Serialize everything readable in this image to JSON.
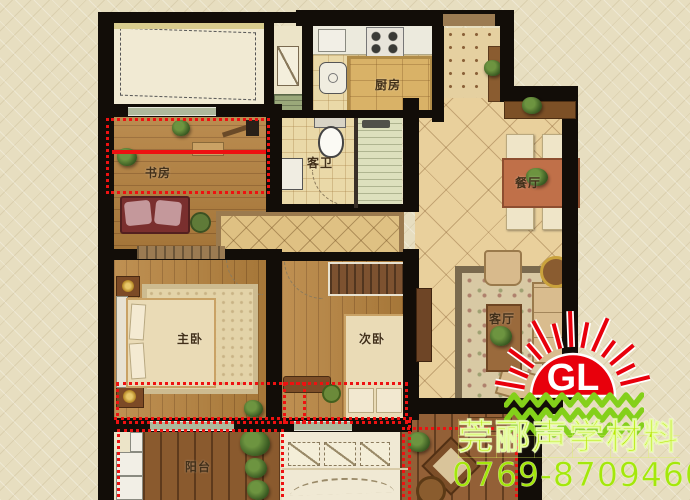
{
  "plan": {
    "rooms": {
      "study": {
        "label": "书房"
      },
      "master_bedroom": {
        "label": "主卧"
      },
      "second_bedroom": {
        "label": "次卧"
      },
      "kitchen": {
        "label": "厨房"
      },
      "guest_bathroom": {
        "label": "客卫"
      },
      "dining_room": {
        "label": "餐厅"
      },
      "living_room": {
        "label": "客厅"
      },
      "balcony": {
        "label": "阳台"
      }
    },
    "annotation": {
      "highlight_color": "#ee1111",
      "style": "red dotted outlines and solid red line marking treated zones"
    }
  },
  "watermark": {
    "logo_initials": "GL",
    "logo_sun_color": "#e8000c",
    "logo_wave_color": "#84d01a",
    "company_name": "莞郦声学材料",
    "company_text_color": "#b6ea00",
    "phone": "0769-87094602",
    "phone_text_color": "#a4e70b"
  }
}
